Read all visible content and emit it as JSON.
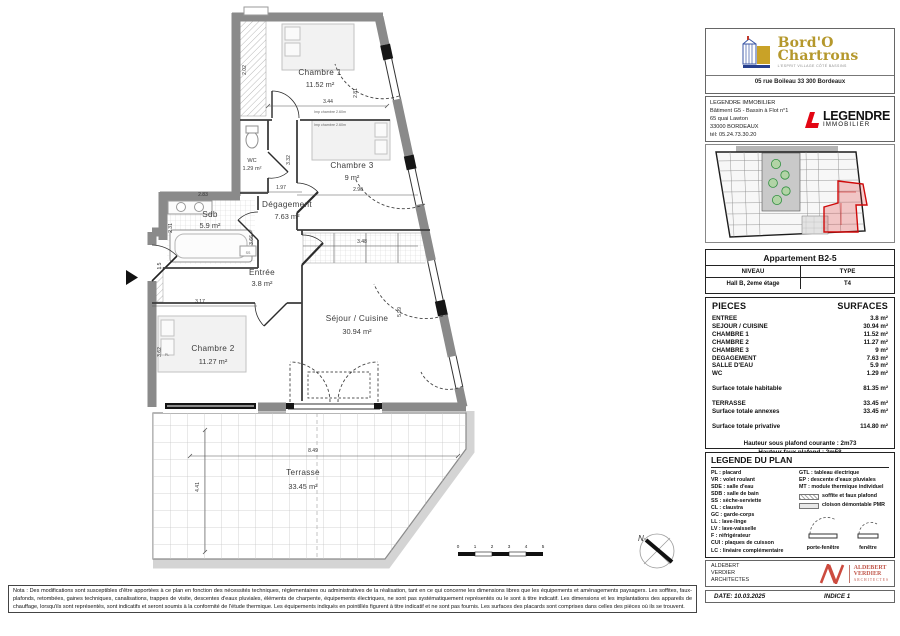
{
  "plan": {
    "rooms": [
      {
        "name": "Chambre 1",
        "area": "11.52 m²"
      },
      {
        "name": "Chambre 3",
        "area": "9 m²"
      },
      {
        "name": "WC",
        "area": "1.29 m²"
      },
      {
        "name": "Sdb",
        "area": "5.9 m²"
      },
      {
        "name": "Dégagement",
        "area": "7.63 m²"
      },
      {
        "name": "Entrée",
        "area": "3.8 m²"
      },
      {
        "name": "Chambre 2",
        "area": "11.27 m²"
      },
      {
        "name": "Séjour / Cuisine",
        "area": "30.94 m²"
      },
      {
        "name": "Terrasse",
        "area": "33.45 m²"
      }
    ],
    "dims": {
      "pl_height": "2.02",
      "chambre1_width": "3.44",
      "chambre1_window": "2.81",
      "chambre3_height": "3.32",
      "chambre3_width": "2.90",
      "degagement_width": "1.97",
      "sdb_width": "2.83",
      "sdb_height": "2.31",
      "entree_height": "3.66",
      "entry_door": "1.5",
      "chambre2_width": "3.17",
      "chambre2_height": "3.62",
      "cuisine_width": "3.48",
      "sejour_height": "5.99",
      "terrasse_width": "8.49",
      "terrasse_height": "4.41"
    },
    "annotations": {
      "imp_chambre": "Imp chambre 2.60m",
      "ss": "SS",
      "pl": "PL"
    },
    "scale": [
      "0",
      "1",
      "2",
      "3",
      "4",
      "5"
    ],
    "north": "N"
  },
  "branding": {
    "name_line1": "Bord'O",
    "name_line2": "Chartrons",
    "tagline": "L'ESPRIT VILLAGE CÔTÉ BASSINS",
    "address": "05 rue Boileau 33 300 Bordeaux"
  },
  "developer": {
    "name": "LEGENDRE IMMOBILIER",
    "line2": "Bâtiment G5 - Bassin à Flot n°1",
    "line3": "65 quai Lawton",
    "line4": "33000 BORDEAUX",
    "line5": "tél: 05.24.73.30.20",
    "logo_text": "LEGENDRE",
    "logo_sub": "IMMOBILIER"
  },
  "apartment": {
    "title": "Appartement B2-5",
    "col_niveau": "NIVEAU",
    "col_type": "TYPE",
    "niveau": "Hall B, 2eme étage",
    "type": "T4"
  },
  "surfaces": {
    "header_left": "PIECES",
    "header_right": "SURFACES",
    "rows": [
      {
        "label": "ENTREE",
        "value": "3.8 m²"
      },
      {
        "label": "SEJOUR / CUISINE",
        "value": "30.94 m²"
      },
      {
        "label": "CHAMBRE 1",
        "value": "11.52 m²"
      },
      {
        "label": "CHAMBRE 2",
        "value": "11.27 m²"
      },
      {
        "label": "CHAMBRE 3",
        "value": "9 m²"
      },
      {
        "label": "DEGAGEMENT",
        "value": "7.63 m²"
      },
      {
        "label": "SALLE D'EAU",
        "value": "5.9 m²"
      },
      {
        "label": "WC",
        "value": "1.29 m²"
      }
    ],
    "total_habitable": {
      "label": "Surface totale habitable",
      "value": "81.35 m²"
    },
    "terrasse": {
      "label": "TERRASSE",
      "value": "33.45 m²"
    },
    "total_annexes": {
      "label": "Surface totale annexes",
      "value": "33.45 m²"
    },
    "total_privative": {
      "label": "Surface totale privative",
      "value": "114.80 m²"
    },
    "note1": "Hauteur sous plafond courante : 2m73",
    "note2": "Hauteur faux plafond : 2m58"
  },
  "legend": {
    "title": "LEGENDE DU PLAN",
    "left": [
      "PL : placard",
      "VR : volet roulant",
      "SDE : salle d'eau",
      "SDB : salle de bain",
      "SS : sèche-serviette",
      "CL : claustra",
      "GC : garde-corps",
      "LL : lave-linge",
      "LV : lave-vaisselle",
      "F : réfrigérateur",
      "CUI : plaques de cuisson",
      "LC : linéaire complémentaire"
    ],
    "right": [
      "GTL : tableau électrique",
      "EP : descente d'eaux pluviales",
      "MT : module thermique individuel"
    ],
    "swatch1": "soffite et faux plafond",
    "swatch2": "cloison démontable PMR",
    "window1": "porte-fenêtre",
    "window2": "fenêtre"
  },
  "architect": {
    "line1": "ALDEBERT",
    "line2": "VERDIER",
    "line3": "ARCHITECTES",
    "logo_line1": "ALDEBERT",
    "logo_line2": "VERDIER",
    "logo_line3": "ARCHITECTES"
  },
  "footer": {
    "date": "DATE: 10.03.2025",
    "indice": "INDICE 1"
  },
  "nota": "Nota : Des modifications sont susceptibles d'être apportées à ce plan en fonction des nécessités techniques, réglementaires ou administratives de la réalisation, tant en ce qui concerne les dimensions libres que les équipements et aménagements paysagers. Les soffites, faux-plafonds, retombées, gaines techniques, canalisations, trappes de visite, descentes d'eaux pluviales, éléments de charpente, équipements électriques, ne sont pas systématiquement représentés ou le sont à titre indicatif. Les dimensions et les implantations des appareils de chauffage, lorsqu'ils sont représentés, sont indicatifs et seront soumis à la conformité de l'étude thermique. Les équipements indiqués en pointillés figurent à titre indicatif et ne sont pas fournis. Les surfaces des placards sont comprises dans celles des pièces où ils se trouvent."
}
